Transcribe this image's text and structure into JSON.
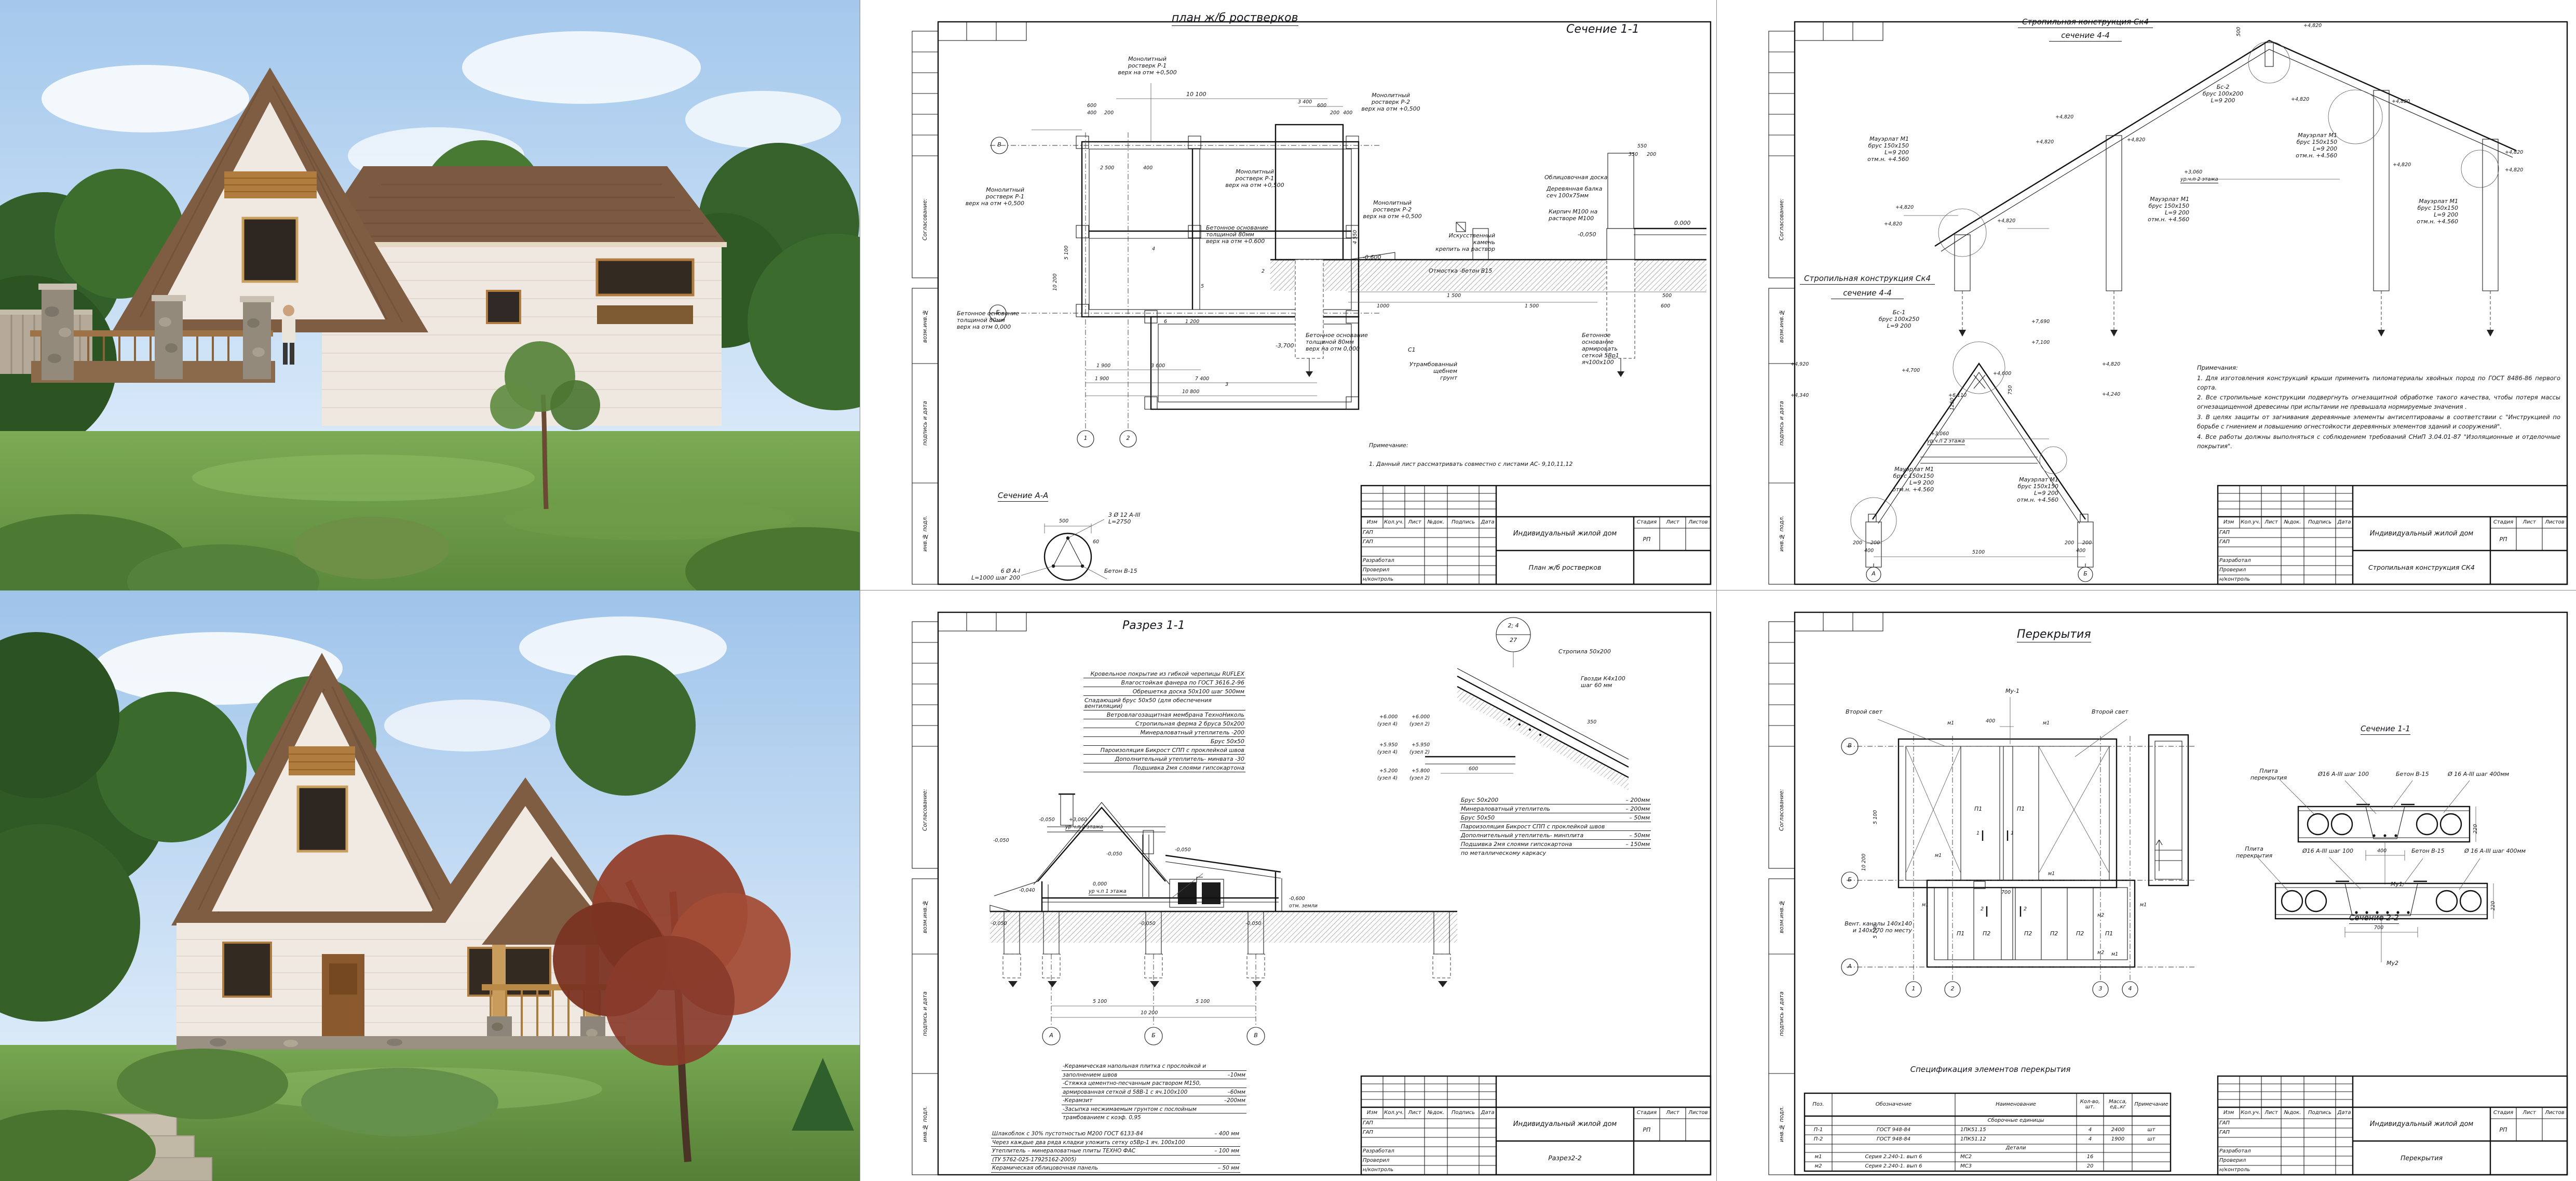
{
  "common": {
    "project": "Индивидуальный жилой дом",
    "stage_label": "Стадия",
    "list_label": "Лист",
    "listov_label": "Листов",
    "stage": "РП",
    "rev_cols": [
      "Изм",
      "Кол.уч.",
      "Лист",
      "№док.",
      "Подпись",
      "Дата"
    ],
    "roles": [
      "ГАП",
      "ГАП",
      "",
      "Разработал",
      "Проверил",
      "н/контроль"
    ],
    "side": [
      "Согласование:",
      "возм.инв.№",
      "подпись и дата",
      "инв.№ подл."
    ]
  },
  "plan": {
    "title": "план ж/б ростверков",
    "doc": "План ж/б ростверков",
    "sec11": "Сечение 1-1",
    "secAA": "Сечение А-А",
    "note_h": "Примечание:",
    "note1": "1. Данный  лист рассматривать   совместно с листами АС- 9,10,11,12",
    "ros_p1": "Монолитный\nростверк Р-1\nверх на отм  +0,500",
    "ros_p2": "Монолитный\nростверк Р-2\nверх на отм +0,500",
    "base600": "Бетонное основание\nтолщиной 80мм\nверх на отм +0.600",
    "base000": "Бетонное основание\nтолщиной 80мм\nверх на отм 0,000",
    "oblic": "Облицовочная доска",
    "balka": "Деревянная балка\nсеч 100х75мм",
    "kirpich": "Кирпич М100 на\nрастворе М100",
    "kamen": "Искусственный камень\nкрепить на раствор",
    "otmostka": "Отмостка -бетон В15",
    "grunt": "Утрамбованный\nщебнем\nгрунт",
    "base_arm": "Бетонное\nоснование\nармировать\nсеткой 5Вр1\nяч100х100",
    "c1": "С1",
    "rebar1": "3 Ø 12 А-III\nL=2750",
    "rebar2": "6 Ø А-I\nL=1000 шаг 200",
    "beton": "Бетон В-15",
    "e000": "0.000",
    "em005": "-0,050",
    "em06": "-0,600",
    "em37": "-3,700",
    "axV": "В",
    "axB": "Б",
    "ax1": "1",
    "ax2": "2",
    "m2": "2",
    "m3": "3",
    "m4": "4",
    "m5": "5",
    "m6": "6",
    "d10100": "10 100",
    "d600": "600",
    "d400": "400",
    "d200": "200",
    "d2500": "2 500",
    "d1200": "1 200",
    "d1900": "1 900",
    "d3600": "3 600",
    "d7400": "7 400",
    "d10800": "10 800",
    "d3400": "3 400",
    "d1500": "1 500",
    "d1000": "1000",
    "d500": "500",
    "d550": "550",
    "d350": "350",
    "d5100": "5 100",
    "d10200": "10 200",
    "d60": "60",
    "d4550": "4 550"
  },
  "truss": {
    "head": "Стропильная конструкция Ск4",
    "sub": "сечение 4-4",
    "doc": "Стропильная конструкция СК4",
    "mauerlat": "Мауэрлат М1\nбрус 150х150\nL=9 200\nотм.н. +4.560",
    "bs2": "Бс-2\nбрус 100х200\nL=9 200",
    "bs1": "Бс-1\nбрус 100х250\nL=9 200",
    "e4820": "+4,820",
    "e7690": "+7,690",
    "e7100": "+7,100",
    "e6110": "+6,110",
    "e4920": "+4,920",
    "e4340": "+4,340",
    "e4700": "+4,700",
    "e4600": "+4,600",
    "e4240": "+4,240",
    "e3060": "+3,060",
    "ur2": "ур.ч.п 2 этажа",
    "d200": "200",
    "d400": "400",
    "d5100": "5100",
    "d500": "500",
    "d1250": "1250",
    "d750": "750",
    "axA": "А",
    "axB": "Б",
    "notes_h": "Примечания:",
    "n1": "1. Для изготовления  конструкций крыши применить пиломатериалы  хвойных пород по ГОСТ 8486-86 первого сорта.",
    "n2": "2. Все стропильные  конструкции подвергнуть огнезащитной обработке такого качества, чтобы потеря массы огнезащищенной древесины при испытании не превышала нормируемые значения .",
    "n3": "3. В целях защиты от загнивания деревянные элементы антисептированы в соответствии с \"Инструкцией по борьбе с гниением и повышению огнестойкости деревянных элементов зданий и сооружений\".",
    "n4": "4.  Все работы должны выполняться с соблюдением  требований СНиП 3.04.01-87 \"Изоляционные и отделочные покрытия\"."
  },
  "razrez": {
    "title": "Разрез 1-1",
    "doc": "Разрез2-2",
    "roof": [
      "Кровельное покрытие из гибкой черепицы RUFLEX",
      "Влагостойкая фанера по ГОСТ 3616.2-96",
      "Обрешетка доска 50х100 шаг 500мм",
      "Спадающий брус 50х50 (для обеспечения вентиляции)",
      "Ветровлагозащитная мембрана ТехноНиколь",
      "Стропильная ферма 2 бруса 50х200",
      "Минераловатный утеплитель    -200",
      "Брус 50х50",
      "Пароизоляция Бикрост СПП с проклейкой швов",
      "Дополнительный утеплитель- минвата  -30",
      "Подшивка 2мя слоями гипсокартона"
    ],
    "node_top": "2; 4",
    "node_bot": "27",
    "stropila": "Стропила 50х200",
    "gvozdi": "Гвозди К4х100\nшаг 60 мм",
    "e6000": "+6.000",
    "e5950": "+5.950",
    "e5200": "+5.200",
    "e5800": "+5.800",
    "uz4": "(узел 4)",
    "uz2": "(узел 2)",
    "layers": [
      {
        "t": "Брус 50х200",
        "v": "– 200мм"
      },
      {
        "t": "Минераловатный утеплитель",
        "v": "– 200мм"
      },
      {
        "t": "Брус 50х50",
        "v": "– 50мм"
      },
      {
        "t": "Пароизоляция Бикрост СПП с проклейкой швов",
        "v": ""
      },
      {
        "t": "Дополнительный утеплитель- минплита",
        "v": "– 50мм"
      },
      {
        "t": "Подшивка 2мя слоями гипсокартона",
        "v": "– 150мм"
      },
      {
        "t": "по металлическому каркасу",
        "v": ""
      }
    ],
    "floor": [
      {
        "t": "-Керамическая напольная плитка с прослойкой и",
        "v": ""
      },
      {
        "t": "заполнением швов",
        "v": "–10мм"
      },
      {
        "t": "-Стяжка цементно-песчанным раствором М150,",
        "v": ""
      },
      {
        "t": "армированная сеткой d 58В-1 с яч.100х100",
        "v": "–60мм"
      },
      {
        "t": "-Керамзит",
        "v": "–200мм"
      },
      {
        "t": "-Засыпка несжимаемым грунтом с послойным",
        "v": ""
      },
      {
        "t": "трамбованием с коэф. 0,95",
        "v": ""
      }
    ],
    "wall": [
      {
        "t": "Шлакоблок с 30% пустотностью М200 ГОСТ 6133-84",
        "v": "– 400 мм"
      },
      {
        "t": "Через каждые два ряда кладки уложить сетку о5Вр-1 яч. 100х100",
        "v": ""
      },
      {
        "t": "Утеплитель – минераловатные плиты ТЕХНО ФАС",
        "v": "– 100 мм"
      },
      {
        "t": "(ТУ 5762-025-17925162-2005)",
        "v": ""
      },
      {
        "t": "Керамическая облицовочная панель",
        "v": "– 50 мм"
      }
    ],
    "e0000": "0,000",
    "ur1": "ур ч.п 1 этажа",
    "em06": "-0,600",
    "zem": "отм. земли",
    "em005": "-0,050",
    "em004": "-0,040",
    "e3060": "+3,060",
    "ur2": "ур ч.п 2 этажа",
    "d5100": "5 100",
    "d10200": "10 200",
    "d600": "600",
    "d350": "350",
    "axA": "А",
    "axB": "Б",
    "axV": "В"
  },
  "slabs": {
    "title": "Перекрытия",
    "doc": "Перекрытия",
    "vtoroy": "Второй свет",
    "mu1": "Му-1",
    "m1": "м1",
    "m2": "м2",
    "p1": "П1",
    "p2": "П2",
    "vent": "Вент. каналы 140х140\nи 140х270 по месту",
    "sec11": "Сечение 1-1",
    "sec22": "Сечение 2-2",
    "plita": "Плита\nперекрытия",
    "arm100": "Ø16 А-III шаг 100",
    "beton": "Бетон В-15",
    "arm400": "Ø 16 А-III шаг 400мм",
    "mu1d": "Му1",
    "mu2d": "Му2",
    "d400": "400",
    "d700": "700",
    "d220": "220",
    "d5100": "5 100",
    "d10200": "10 200",
    "ax1": "1",
    "ax2": "2",
    "ax3": "3",
    "ax4": "4",
    "axA": "А",
    "axB": "Б",
    "axV": "В",
    "spec_title": "Спецификация элементов перекрытия",
    "col_pos": "Поз.",
    "col_ob": "Обозначение",
    "col_name": "Наименование",
    "col_qty": "Кол-во,\nшт.",
    "col_mass": "Масса,\nед.,кг",
    "col_note": "Примечание",
    "group1": "Сборочные единицы",
    "group2": "Детали",
    "rows": [
      {
        "pos": "П-1",
        "ob": "ГОСТ 948-84",
        "name": "1ПК51.15",
        "qty": "4",
        "mass": "2400",
        "note": "шт"
      },
      {
        "pos": "П-2",
        "ob": "ГОСТ 948-84",
        "name": "1ПК51.12",
        "qty": "4",
        "mass": "1900",
        "note": "шт"
      },
      {
        "pos": "м1",
        "ob": "Серия 2.240-1. вып 6",
        "name": "МС2",
        "qty": "16",
        "mass": "",
        "note": ""
      },
      {
        "pos": "м2",
        "ob": "Серия 2.240-1. вып 6",
        "name": "МС3",
        "qty": "20",
        "mass": "",
        "note": ""
      }
    ]
  }
}
